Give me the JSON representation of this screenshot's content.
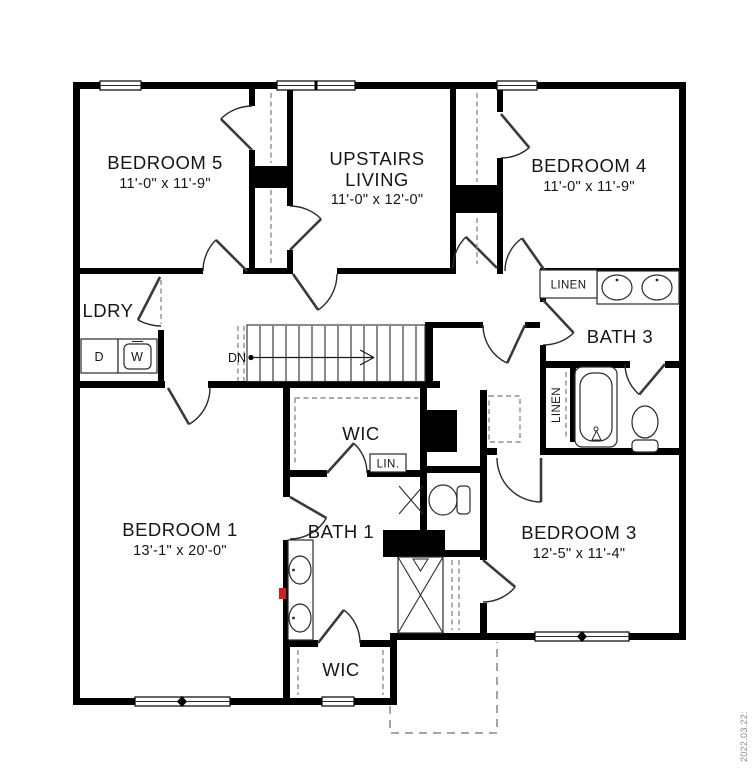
{
  "floorplan": {
    "rooms": {
      "bedroom5": {
        "name": "BEDROOM 5",
        "dims": "11'-0\" x 11'-9\""
      },
      "upstairs_living": {
        "name_line1": "UPSTAIRS",
        "name_line2": "LIVING",
        "dims": "11'-0\" x 12'-0\""
      },
      "bedroom4": {
        "name": "BEDROOM 4",
        "dims": "11'-0\" x 11'-9\""
      },
      "bedroom1": {
        "name": "BEDROOM 1",
        "dims": "13'-1\" x 20'-0\""
      },
      "bedroom3": {
        "name": "BEDROOM 3",
        "dims": "12'-5\" x 11'-4\""
      },
      "bath1": {
        "name": "BATH 1"
      },
      "bath3": {
        "name": "BATH 3"
      },
      "laundry": {
        "name": "LDRY"
      },
      "wic_center": {
        "name": "WIC"
      },
      "wic_bottom": {
        "name": "WIC"
      },
      "linen_hall": {
        "name": "LINEN"
      },
      "linen_bath3": {
        "name": "LINEN"
      },
      "linen_small": {
        "name": "LIN."
      }
    },
    "labels": {
      "stairs_direction": "DN",
      "dryer": "D",
      "washer": "W"
    },
    "stamp": {
      "date": "2022.03.22:"
    },
    "colors": {
      "walls": "#000000",
      "background": "#ffffff",
      "dashed_lines": "#8f8f8f",
      "marker_red": "#cc2222"
    }
  }
}
